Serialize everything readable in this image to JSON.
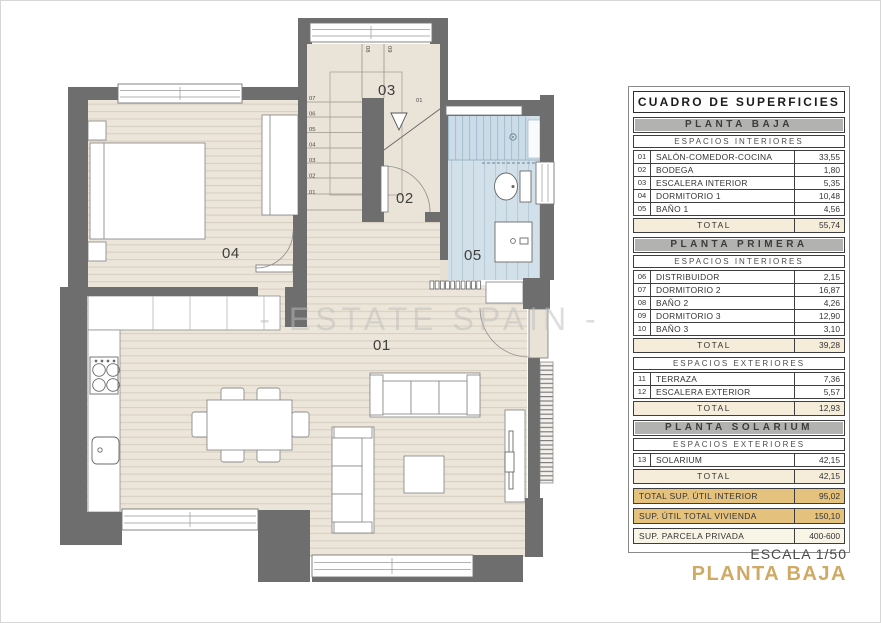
{
  "panel": {
    "title": "CUADRO DE SUPERFICIES",
    "planta_baja": {
      "header": "PLANTA BAJA",
      "subheader": "ESPACIOS INTERIORES",
      "rows": [
        {
          "num": "01",
          "name": "SALÓN-COMEDOR-COCINA",
          "value": "33,55"
        },
        {
          "num": "02",
          "name": "BODEGA",
          "value": "1,80"
        },
        {
          "num": "03",
          "name": "ESCALERA INTERIOR",
          "value": "5,35"
        },
        {
          "num": "04",
          "name": "DORMITORIO 1",
          "value": "10,48"
        },
        {
          "num": "05",
          "name": "BAÑO 1",
          "value": "4,56"
        }
      ],
      "total_label": "TOTAL",
      "total_value": "55,74"
    },
    "planta_primera": {
      "header": "PLANTA PRIMERA",
      "int_subheader": "ESPACIOS INTERIORES",
      "int_rows": [
        {
          "num": "06",
          "name": "DISTRIBUIDOR",
          "value": "2,15"
        },
        {
          "num": "07",
          "name": "DORMITORIO 2",
          "value": "16,87"
        },
        {
          "num": "08",
          "name": "BAÑO 2",
          "value": "4,26"
        },
        {
          "num": "09",
          "name": "DORMITORIO 3",
          "value": "12,90"
        },
        {
          "num": "10",
          "name": "BAÑO 3",
          "value": "3,10"
        }
      ],
      "int_total_label": "TOTAL",
      "int_total_value": "39,28",
      "ext_subheader": "ESPACIOS EXTERIORES",
      "ext_rows": [
        {
          "num": "11",
          "name": "TERRAZA",
          "value": "7,36"
        },
        {
          "num": "12",
          "name": "ESCALERA EXTERIOR",
          "value": "5,57"
        }
      ],
      "ext_total_label": "TOTAL",
      "ext_total_value": "12,93"
    },
    "planta_solarium": {
      "header": "PLANTA SOLARIUM",
      "subheader": "ESPACIOS EXTERIORES",
      "rows": [
        {
          "num": "13",
          "name": "SOLARIUM",
          "value": "42,15"
        }
      ],
      "total_label": "TOTAL",
      "total_value": "42,15"
    },
    "summary": [
      {
        "label": "TOTAL SUP. ÚTIL INTERIOR",
        "value": "95,02"
      },
      {
        "label": "SUP. ÚTIL TOTAL VIVIENDA",
        "value": "150,10"
      },
      {
        "label": "SUP. PARCELA PRIVADA",
        "value": "400-600"
      }
    ]
  },
  "plan": {
    "watermark": "- ESTATE SPAIN -",
    "rooms": [
      {
        "num": "01"
      },
      {
        "num": "02"
      },
      {
        "num": "03"
      },
      {
        "num": "04"
      },
      {
        "num": "05"
      }
    ],
    "stair_steps": [
      "01",
      "02",
      "03",
      "04",
      "05",
      "06",
      "07"
    ],
    "upper_steps": [
      "08",
      "09"
    ],
    "door_tag": "01"
  },
  "footer": {
    "scale": "ESCALA 1/50",
    "plan_title": "PLANTA BAJA"
  },
  "colors": {
    "accent_gold": "#d0a964",
    "gold_row": "#e4c17c",
    "total_cream": "#f5edda",
    "header_gray": "#b2b2b0",
    "wall_gray": "#6e6e6e",
    "bath_blue": "#d2e0ea",
    "wood": "#ece5d9"
  }
}
